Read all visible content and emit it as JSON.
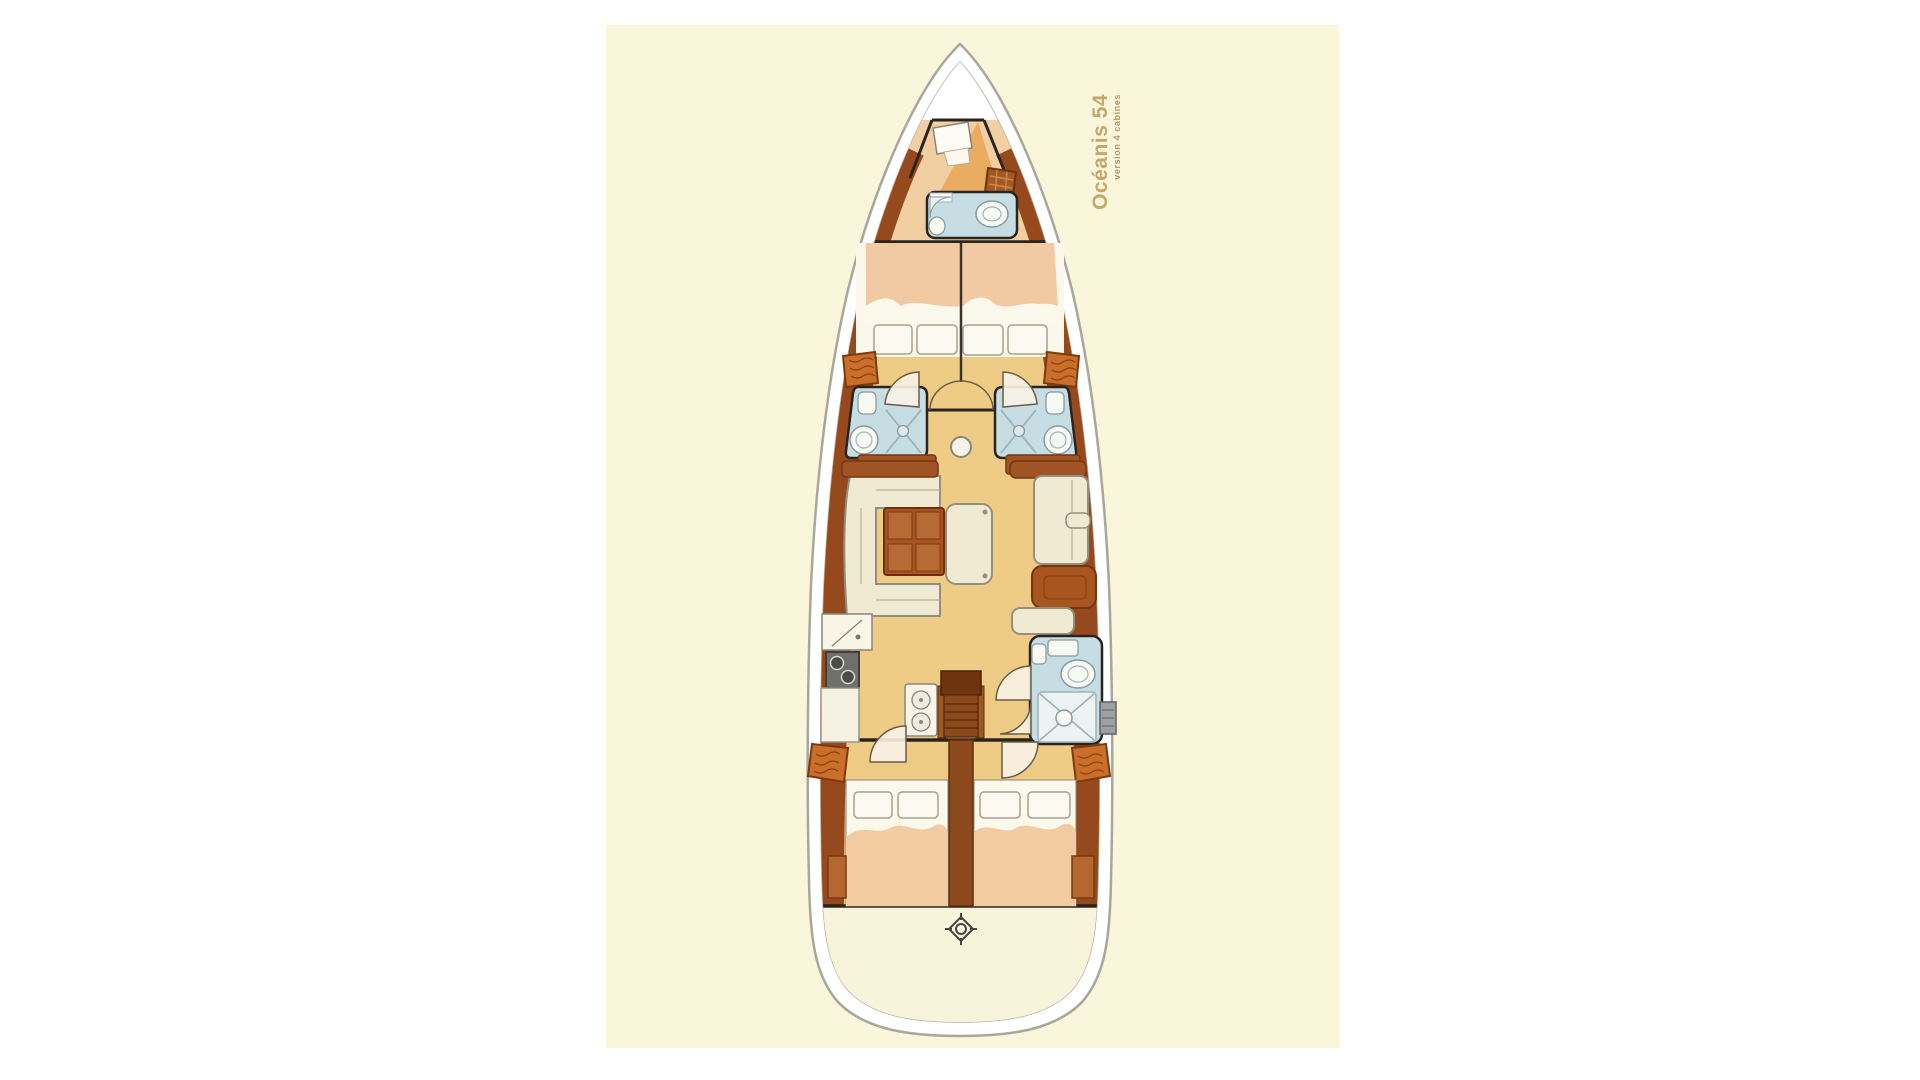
{
  "artwork": {
    "title": "Océanis 54",
    "subtitle": "version 4 cabines"
  },
  "colors": {
    "page_background": "#ffffff",
    "panel_background": "#faf6db",
    "hull_white": "#ffffff",
    "hull_outline": "#a8a79b",
    "floor_gold": "#efcc86",
    "crew_floor_peach": "#f2cfa3",
    "bow_triangle_orange": "#e9ac60",
    "wood_brown": "#97491e",
    "wood_dark": "#6e3410",
    "bathroom_blue": "#c5dde3",
    "mattress_peach": "#f2cba2",
    "bedding_white": "#fbf8ec",
    "upholstery_cream": "#f1ead2",
    "table_brown": "#a75322",
    "stern_floor": "#f8f4dc",
    "title_text": "#c2a869"
  }
}
